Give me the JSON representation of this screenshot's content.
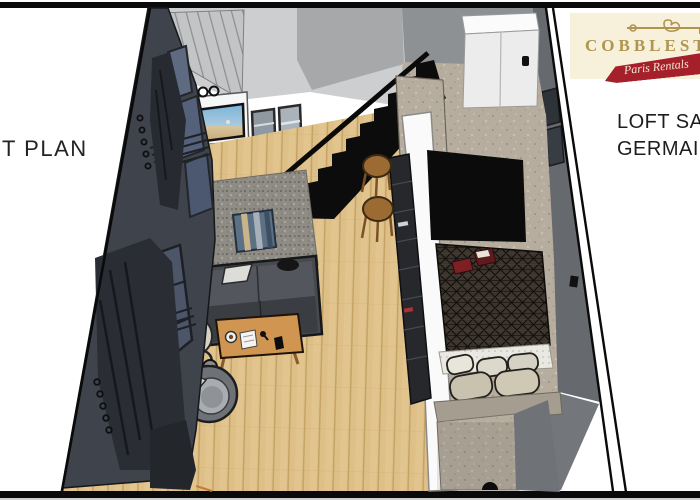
{
  "frame": {
    "left_caption": "T PLAN"
  },
  "right_panel": {
    "line1": "LOFT SAINT",
    "line2": "GERMAIN"
  },
  "logo": {
    "brand": "COBBLESTONE",
    "tagline": "Paris Rentals",
    "bg": "#f7f0da",
    "gold": "#b09550",
    "red": "#a6202c"
  },
  "colors": {
    "floor_wood": "#ddbf87",
    "wall_dark": "#3f444c",
    "wall_light": "#cdced0",
    "wall_mid": "#a6a8aa",
    "wall_kitchen": "#8e9194",
    "right_wall": "#66696d",
    "stairs": "#0c0c0c",
    "rug": "#8f8b85",
    "duvet": "#3c352d",
    "accent_table": "#cf9551",
    "stool": "#9c6a33",
    "concrete": "#b6ad9f",
    "sofa": "#46494e"
  },
  "scene": {
    "items": [
      "wardrobe",
      "tv-unit",
      "framed-pictures",
      "staircase",
      "handrail",
      "bar-stools",
      "kitchen-cabinet",
      "window-wall",
      "curtains",
      "area-rug",
      "floor-pouf",
      "sofa",
      "coffee-table",
      "floor-lamp",
      "armchair",
      "partition-wall",
      "bookshelf-counter",
      "bed",
      "duvet",
      "pillows",
      "bed-platform"
    ]
  }
}
